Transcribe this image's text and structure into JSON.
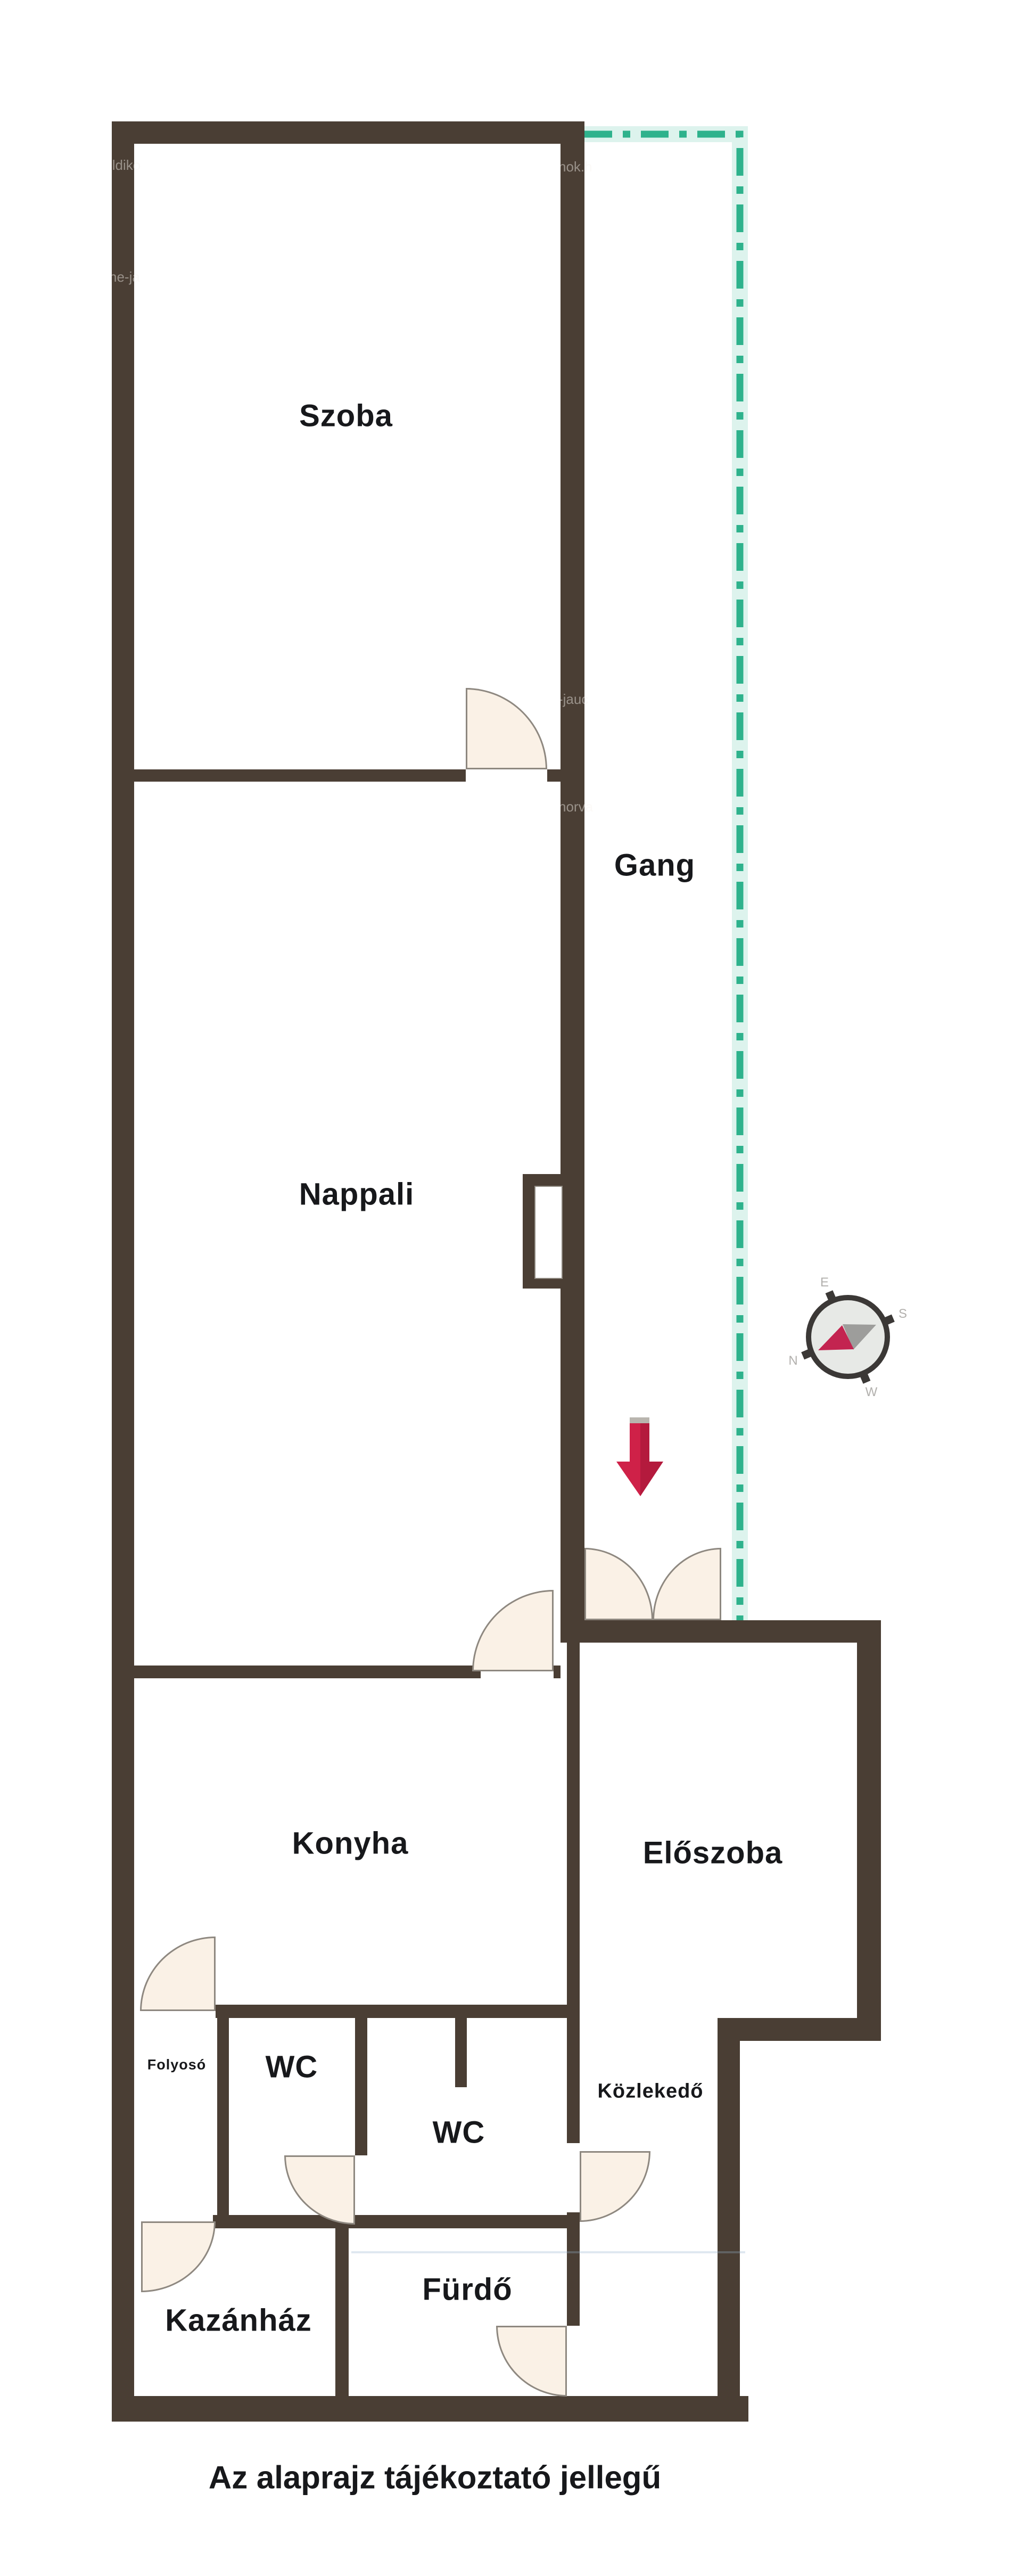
{
  "caption": "Az alaprajz tájékoztató jellegű",
  "rooms": {
    "szoba": {
      "label": "Szoba"
    },
    "gang": {
      "label": "Gang"
    },
    "nappali": {
      "label": "Nappali"
    },
    "konyha": {
      "label": "Konyha"
    },
    "eloszoba": {
      "label": "Előszoba"
    },
    "folyoso": {
      "label": "Folyosó"
    },
    "wc1": {
      "label": "WC"
    },
    "wc2": {
      "label": "WC"
    },
    "kozlekedo": {
      "label": "Közlekedő"
    },
    "kazanhaz": {
      "label": "Kazánház"
    },
    "furdo": {
      "label": "Fürdő"
    }
  },
  "compass": {
    "n": "N",
    "e": "E",
    "s": "S",
    "w": "W"
  },
  "watermark_fragments": {
    "a": "ildiko",
    "b": "ne-ja",
    "c": "nok.h",
    "d": "-jauc",
    "e": "horva"
  },
  "colors": {
    "wall": "#4a3e34",
    "balcony_line": "#2eb28c",
    "entry_arrow": "#c92048",
    "door_fill": "#faf1e6",
    "door_stroke": "#8e8880",
    "label_text": "#17181b"
  }
}
